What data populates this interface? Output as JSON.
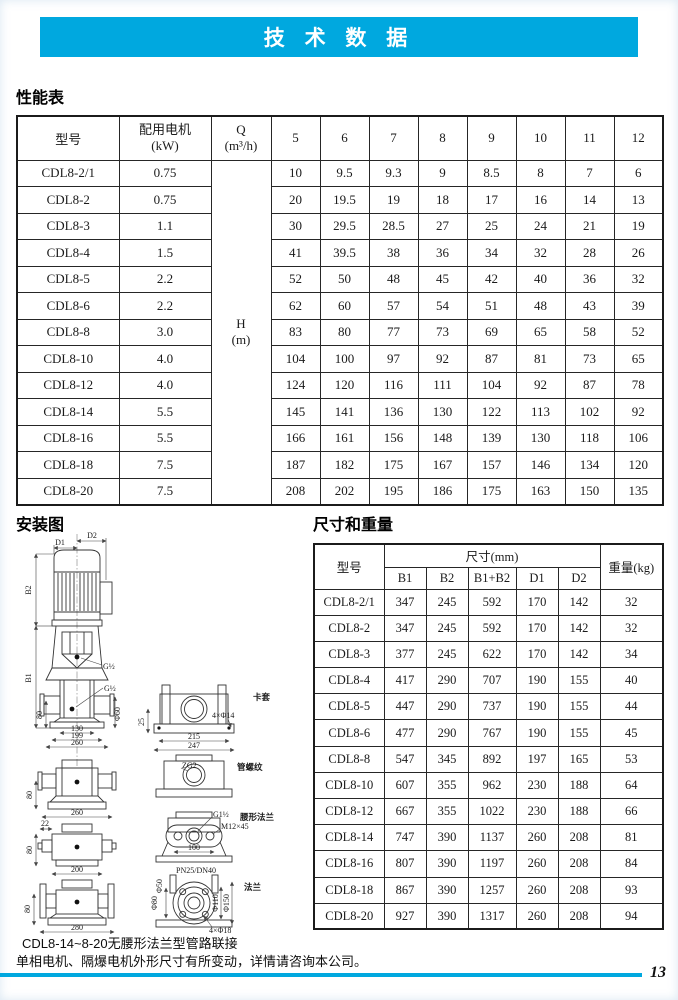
{
  "banner": {
    "title": "技 术 数 据",
    "accent_color": "#00a8df"
  },
  "perf": {
    "heading": "性能表",
    "header": {
      "model": "型号",
      "motor1": "配用电机",
      "motor2": "(kW)",
      "q1": "Q",
      "q2": "(m³/h)",
      "flow": [
        "5",
        "6",
        "7",
        "8",
        "9",
        "10",
        "11",
        "12"
      ]
    },
    "hcell": {
      "l1": "H",
      "l2": "(m)"
    },
    "rows": [
      {
        "model": "CDL8-2/1",
        "kw": "0.75",
        "h": [
          "10",
          "9.5",
          "9.3",
          "9",
          "8.5",
          "8",
          "7",
          "6"
        ]
      },
      {
        "model": "CDL8-2",
        "kw": "0.75",
        "h": [
          "20",
          "19.5",
          "19",
          "18",
          "17",
          "16",
          "14",
          "13"
        ]
      },
      {
        "model": "CDL8-3",
        "kw": "1.1",
        "h": [
          "30",
          "29.5",
          "28.5",
          "27",
          "25",
          "24",
          "21",
          "19"
        ]
      },
      {
        "model": "CDL8-4",
        "kw": "1.5",
        "h": [
          "41",
          "39.5",
          "38",
          "36",
          "34",
          "32",
          "28",
          "26"
        ]
      },
      {
        "model": "CDL8-5",
        "kw": "2.2",
        "h": [
          "52",
          "50",
          "48",
          "45",
          "42",
          "40",
          "36",
          "32"
        ]
      },
      {
        "model": "CDL8-6",
        "kw": "2.2",
        "h": [
          "62",
          "60",
          "57",
          "54",
          "51",
          "48",
          "43",
          "39"
        ]
      },
      {
        "model": "CDL8-8",
        "kw": "3.0",
        "h": [
          "83",
          "80",
          "77",
          "73",
          "69",
          "65",
          "58",
          "52"
        ]
      },
      {
        "model": "CDL8-10",
        "kw": "4.0",
        "h": [
          "104",
          "100",
          "97",
          "92",
          "87",
          "81",
          "73",
          "65"
        ]
      },
      {
        "model": "CDL8-12",
        "kw": "4.0",
        "h": [
          "124",
          "120",
          "116",
          "111",
          "104",
          "92",
          "87",
          "78"
        ]
      },
      {
        "model": "CDL8-14",
        "kw": "5.5",
        "h": [
          "145",
          "141",
          "136",
          "130",
          "122",
          "113",
          "102",
          "92"
        ]
      },
      {
        "model": "CDL8-16",
        "kw": "5.5",
        "h": [
          "166",
          "161",
          "156",
          "148",
          "139",
          "130",
          "118",
          "106"
        ]
      },
      {
        "model": "CDL8-18",
        "kw": "7.5",
        "h": [
          "187",
          "182",
          "175",
          "167",
          "157",
          "146",
          "134",
          "120"
        ]
      },
      {
        "model": "CDL8-20",
        "kw": "7.5",
        "h": [
          "208",
          "202",
          "195",
          "186",
          "175",
          "163",
          "150",
          "135"
        ]
      }
    ]
  },
  "dims": {
    "heading": "尺寸和重量",
    "header": {
      "model": "型号",
      "size": "尺寸(mm)",
      "cols": [
        "B1",
        "B2",
        "B1+B2",
        "D1",
        "D2"
      ],
      "weight": "重量(kg)"
    },
    "rows": [
      {
        "model": "CDL8-2/1",
        "b1": "347",
        "b2": "245",
        "b1b2": "592",
        "d1": "170",
        "d2": "142",
        "wt": "32"
      },
      {
        "model": "CDL8-2",
        "b1": "347",
        "b2": "245",
        "b1b2": "592",
        "d1": "170",
        "d2": "142",
        "wt": "32"
      },
      {
        "model": "CDL8-3",
        "b1": "377",
        "b2": "245",
        "b1b2": "622",
        "d1": "170",
        "d2": "142",
        "wt": "34"
      },
      {
        "model": "CDL8-4",
        "b1": "417",
        "b2": "290",
        "b1b2": "707",
        "d1": "190",
        "d2": "155",
        "wt": "40"
      },
      {
        "model": "CDL8-5",
        "b1": "447",
        "b2": "290",
        "b1b2": "737",
        "d1": "190",
        "d2": "155",
        "wt": "44"
      },
      {
        "model": "CDL8-6",
        "b1": "477",
        "b2": "290",
        "b1b2": "767",
        "d1": "190",
        "d2": "155",
        "wt": "45"
      },
      {
        "model": "CDL8-8",
        "b1": "547",
        "b2": "345",
        "b1b2": "892",
        "d1": "197",
        "d2": "165",
        "wt": "53"
      },
      {
        "model": "CDL8-10",
        "b1": "607",
        "b2": "355",
        "b1b2": "962",
        "d1": "230",
        "d2": "188",
        "wt": "64"
      },
      {
        "model": "CDL8-12",
        "b1": "667",
        "b2": "355",
        "b1b2": "1022",
        "d1": "230",
        "d2": "188",
        "wt": "66"
      },
      {
        "model": "CDL8-14",
        "b1": "747",
        "b2": "390",
        "b1b2": "1137",
        "d1": "260",
        "d2": "208",
        "wt": "81"
      },
      {
        "model": "CDL8-16",
        "b1": "807",
        "b2": "390",
        "b1b2": "1197",
        "d1": "260",
        "d2": "208",
        "wt": "84"
      },
      {
        "model": "CDL8-18",
        "b1": "867",
        "b2": "390",
        "b1b2": "1257",
        "d1": "260",
        "d2": "208",
        "wt": "93"
      },
      {
        "model": "CDL8-20",
        "b1": "927",
        "b2": "390",
        "b1b2": "1317",
        "d1": "260",
        "d2": "208",
        "wt": "94"
      }
    ]
  },
  "install": {
    "heading": "安装图",
    "labels": {
      "d1": "D1",
      "d2": "D2",
      "b1": "B1",
      "b2": "B2",
      "g_half": "G½",
      "g1half": "G1½",
      "dim130": "130",
      "dim199": "199",
      "dim260": "260",
      "dim80": "80",
      "phi60": "Φ60",
      "dim25": "25",
      "dim215": "215",
      "dim247": "247",
      "bolt14": "4×Φ14",
      "ferrule": "卡套",
      "zg2": "ZG2",
      "pipe_thread": "管螺纹",
      "dim22": "22",
      "dim200": "200",
      "m12": "M12×45",
      "dim100": "100",
      "waist_flange": "腰形法兰",
      "dim280": "280",
      "pn": "PN25/DN40",
      "phi50": "Φ50",
      "phi80": "Φ80",
      "phi110": "Φ110",
      "phi150": "Φ150",
      "bolt18": "4×Φ18",
      "flange": "法兰"
    }
  },
  "notes": {
    "line1": "CDL8-14~8-20无腰形法兰型管路联接",
    "line2": "单相电机、隔爆电机外形尺寸有所变动，详情请咨询本公司。"
  },
  "footer": {
    "page_number": "13"
  }
}
